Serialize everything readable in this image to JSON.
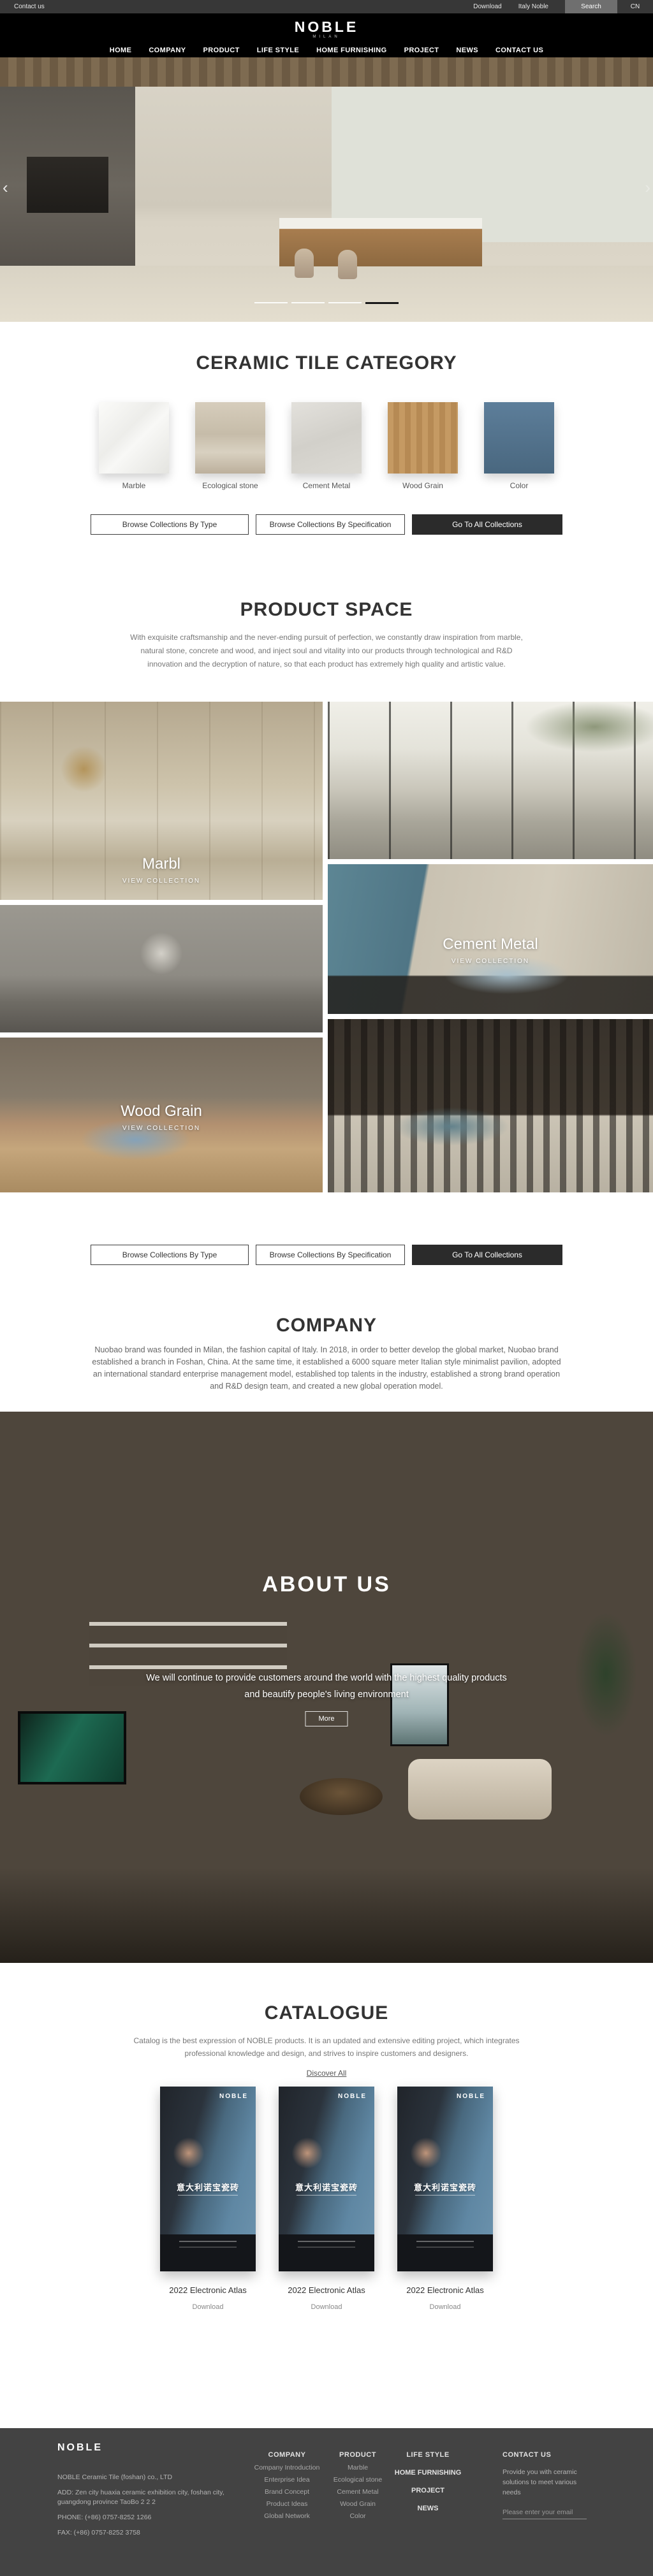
{
  "topbar": {
    "contact_label": "Contact us",
    "download_label": "Download",
    "brand_label": "Italy Noble",
    "search_label": "Search",
    "lang_label": "CN"
  },
  "header": {
    "logo": "NOBLE",
    "logo_sub": "MILAN",
    "nav": [
      "HOME",
      "COMPANY",
      "PRODUCT",
      "LIFE STYLE",
      "HOME FURNISHING",
      "PROJECT",
      "NEWS",
      "CONTACT US"
    ]
  },
  "hero": {
    "prev_icon": "‹",
    "next_icon": "›"
  },
  "category": {
    "title": "CERAMIC TILE CATEGORY",
    "items": [
      "Marble",
      "Ecological stone",
      "Cement Metal",
      "Wood Grain",
      "Color"
    ]
  },
  "collections": {
    "by_type": "Browse Collections By Type",
    "by_spec": "Browse Collections By Specification",
    "go_all": "Go To All Collections"
  },
  "product_space": {
    "title": "PRODUCT SPACE",
    "description": "With exquisite craftsmanship and the never-ending pursuit of perfection, we constantly draw inspiration from marble, natural stone, concrete and wood, and inject soul and vitality into our products through technological and R&D innovation and the decryption of nature, so that each product has extremely high quality and artistic value.",
    "panels": {
      "marble": {
        "name": "Marbl",
        "cta": "VIEW COLLECTION"
      },
      "cement": {
        "name": "Cement Metal",
        "cta": "VIEW COLLECTION"
      },
      "wood": {
        "name": "Wood Grain",
        "cta": "VIEW COLLECTION"
      }
    }
  },
  "company": {
    "title": "COMPANY",
    "description": "Nuobao brand was founded in Milan, the fashion capital of Italy. In 2018, in order to better develop the global market, Nuobao brand established a branch in Foshan, China. At the same time, it established a 6000 square meter Italian style minimalist pavilion, adopted an international standard enterprise management model, established top talents in the industry, established a strong brand operation and R&D design team, and created a new global operation model."
  },
  "about": {
    "title": "ABOUT US",
    "line1": "We will continue to provide customers around the world with the highest quality products",
    "line2": "and beautify people's living environment",
    "more_label": "More"
  },
  "catalogue": {
    "title": "CATALOGUE",
    "description": "Catalog is the best expression of NOBLE products. It is an updated and extensive editing project, which integrates professional knowledge and design, and strives to inspire customers and designers.",
    "discover_label": "Discover All",
    "cover_logo": "NOBLE",
    "cover_title": "意大利诺宝瓷砖",
    "atlas_label": "2022 Electronic Atlas",
    "download_label": "Download"
  },
  "footer": {
    "logo": "NOBLE",
    "company_name": "NOBLE Ceramic Tile (foshan) co., LTD",
    "address": "ADD:  Zen city huaxia ceramic exhibition city, foshan city, guangdong province TaoBo 2 2 2",
    "phone": "PHONE:   (+86)  0757-8252 1266",
    "fax": "FAX:   (+86)  0757-8252 3758",
    "columns": [
      {
        "title": "COMPANY",
        "links": [
          "Company Introduction",
          "Enterprise Idea",
          "Brand Concept",
          "Product Ideas",
          "Global Network"
        ]
      },
      {
        "title": "PRODUCT",
        "links": [
          "Marble",
          "Ecological stone",
          "Cement Metal",
          "Wood Grain",
          "Color"
        ]
      },
      {
        "title": "LIFE STYLE",
        "links": [
          "HOME FURNISHING",
          "PROJECT",
          "NEWS"
        ]
      }
    ],
    "contact": {
      "title": "CONTACT US",
      "text": "Provide you with ceramic solutions to meet various needs",
      "placeholder": "Please enter your email"
    }
  }
}
